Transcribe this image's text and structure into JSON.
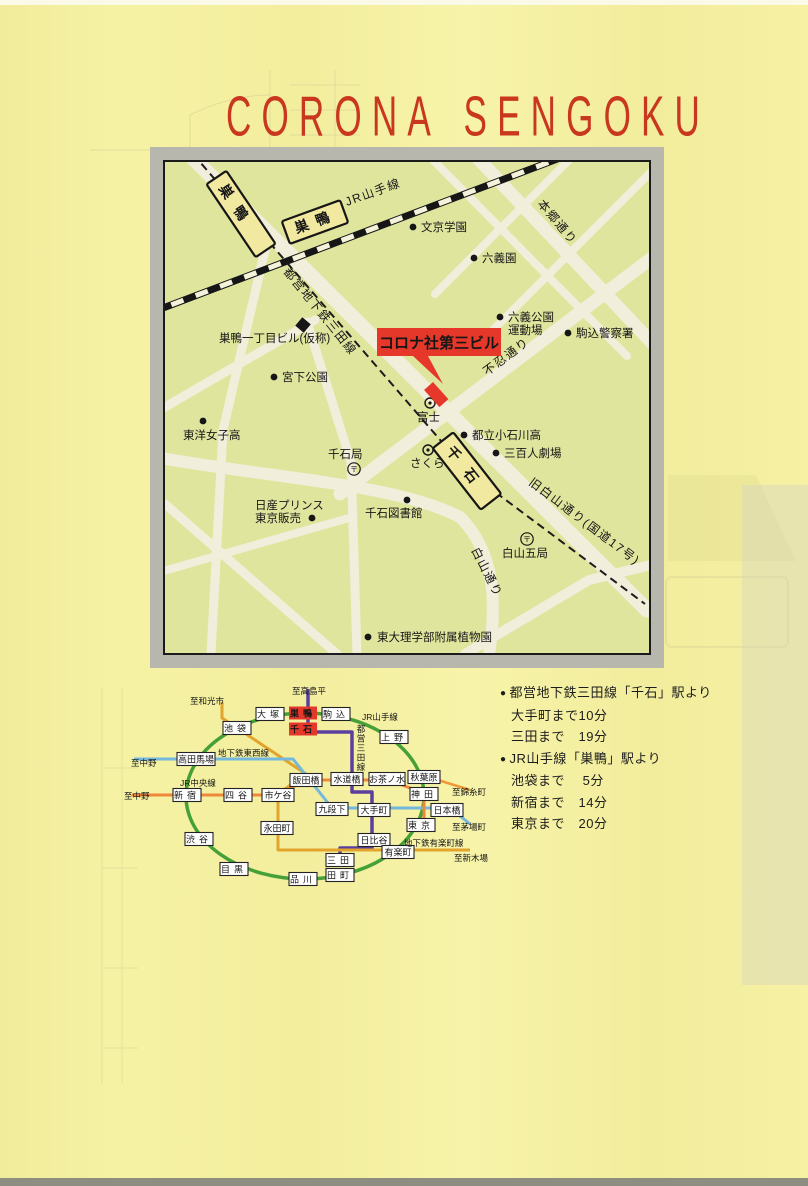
{
  "page": {
    "title": "CORONA SENGOKU"
  },
  "colors": {
    "title_red": "#c8371e",
    "map_bg": "#e0e59e",
    "road": "#f1eedb",
    "marker_red": "#e6382a",
    "jr_green": "#45a038",
    "mita_purple": "#5b3f9e",
    "yurakucho_gold": "#e2a42c",
    "tozai_blue": "#74b8dc",
    "chuo_orange": "#ef8838",
    "frame_gray": "#b7b7ae"
  },
  "map": {
    "roads": [
      {
        "pts": [
          [
            20,
            -12
          ],
          [
            482,
            448
          ]
        ],
        "w": 15
      },
      {
        "pts": [
          [
            305,
            -12
          ],
          [
            488,
            182
          ]
        ],
        "w": 13
      },
      {
        "pts": [
          [
            175,
            332
          ],
          [
            492,
            92
          ]
        ],
        "w": 13
      },
      {
        "path": "M-10,295 C120,318 230,322 295,355 C330,390 332,440 324,492",
        "w": 12
      },
      {
        "pts": [
          [
            -12,
            252
          ],
          [
            150,
            158
          ]
        ],
        "w": 9
      },
      {
        "pts": [
          [
            100,
            88
          ],
          [
            58,
            268
          ],
          [
            46,
            492
          ]
        ],
        "w": 9
      },
      {
        "pts": [
          [
            258,
            -12
          ],
          [
            462,
            194
          ]
        ],
        "w": 8
      },
      {
        "pts": [
          [
            488,
            8
          ],
          [
            316,
            180
          ]
        ],
        "w": 8
      },
      {
        "pts": [
          [
            414,
            -12
          ],
          [
            270,
            132
          ]
        ],
        "w": 8
      },
      {
        "pts": [
          [
            142,
            160
          ],
          [
            186,
            300
          ],
          [
            192,
            492
          ]
        ],
        "w": 9
      },
      {
        "pts": [
          [
            0,
            342
          ],
          [
            172,
            492
          ]
        ],
        "w": 9
      },
      {
        "pts": [
          [
            -12,
            412
          ],
          [
            184,
            356
          ]
        ],
        "w": 8
      },
      {
        "pts": [
          [
            300,
            492
          ],
          [
            424,
            418
          ],
          [
            490,
            402
          ]
        ],
        "w": 10
      }
    ],
    "jr_track": {
      "pts": [
        [
          -18,
          152
        ],
        [
          432,
          -18
        ]
      ]
    },
    "subway_dashed": {
      "pts": [
        [
          28,
          -8
        ],
        [
          302,
          309
        ],
        [
          480,
          442
        ]
      ]
    },
    "road_labels": [
      {
        "text": "JR山手線",
        "x": 182,
        "y": 44,
        "rot": -20
      },
      {
        "text": "都営地下鉄三田線",
        "x": 118,
        "y": 110,
        "rot": 51
      },
      {
        "text": "本郷通り",
        "x": 372,
        "y": 42,
        "rot": 50
      },
      {
        "text": "不忍通り",
        "x": 322,
        "y": 214,
        "rot": -37
      },
      {
        "text": "旧白山通り(国道17号)",
        "x": 363,
        "y": 322,
        "rot": 37
      },
      {
        "text": "白山通り",
        "x": 306,
        "y": 388,
        "rot": 63
      }
    ],
    "stations": [
      {
        "label": "巣鴨",
        "x": 76,
        "y": 52,
        "rot": 56,
        "w": 88,
        "h": 24,
        "ls": 12
      },
      {
        "label": "巣鴨",
        "x": 150,
        "y": 60,
        "rot": -20,
        "w": 62,
        "h": 24,
        "ls": 8
      },
      {
        "label": "千石",
        "x": 302,
        "y": 309,
        "rot": 52,
        "w": 78,
        "h": 26,
        "ls": 14
      }
    ],
    "landmarks": [
      {
        "lines": [
          "文京学園"
        ],
        "tx": 256,
        "ty": 69,
        "marker": "dot",
        "mx": 248,
        "my": 65
      },
      {
        "lines": [
          "六義園"
        ],
        "tx": 317,
        "ty": 100,
        "marker": "dot",
        "mx": 309,
        "my": 96
      },
      {
        "lines": [
          "六義公園",
          "運動場"
        ],
        "tx": 343,
        "ty": 159,
        "marker": "dot",
        "mx": 335,
        "my": 155
      },
      {
        "lines": [
          "駒込警察署"
        ],
        "tx": 411,
        "ty": 175,
        "marker": "dot",
        "mx": 403,
        "my": 171
      },
      {
        "lines": [
          "巣鴨一丁目ビル(仮称)"
        ],
        "tx": 54,
        "ty": 180,
        "marker": "square",
        "mx": 138,
        "my": 163
      },
      {
        "lines": [
          "宮下公園"
        ],
        "tx": 117,
        "ty": 219,
        "marker": "dot",
        "mx": 109,
        "my": 215
      },
      {
        "lines": [
          "東洋女子高"
        ],
        "tx": 18,
        "ty": 277,
        "marker": "dot",
        "mx": 38,
        "my": 259
      },
      {
        "lines": [
          "都立小石川高"
        ],
        "tx": 307,
        "ty": 277,
        "marker": "dot",
        "mx": 299,
        "my": 273
      },
      {
        "lines": [
          "三百人劇場"
        ],
        "tx": 339,
        "ty": 295,
        "marker": "dot",
        "mx": 331,
        "my": 291
      },
      {
        "lines": [
          "千石図書館"
        ],
        "tx": 200,
        "ty": 355,
        "marker": "dot",
        "mx": 242,
        "my": 338
      },
      {
        "lines": [
          "日産プリンス",
          "東京販売"
        ],
        "tx": 90,
        "ty": 347,
        "marker": "dot",
        "mx": 147,
        "my": 356
      },
      {
        "lines": [
          "東大理学部附属植物園"
        ],
        "tx": 212,
        "ty": 479,
        "marker": "dot",
        "mx": 203,
        "my": 475
      }
    ],
    "postals": [
      {
        "text": "千石局",
        "tx": 163,
        "ty": 296,
        "cx": 189,
        "cy": 307
      },
      {
        "text": "白山五局",
        "tx": 337,
        "ty": 395,
        "cx": 362,
        "cy": 377
      }
    ],
    "banks": [
      {
        "text": "富士",
        "tx": 252,
        "ty": 259,
        "cx": 265,
        "cy": 241
      },
      {
        "text": "さくら",
        "tx": 245,
        "ty": 305,
        "cx": 263,
        "cy": 288
      }
    ],
    "corona": {
      "text": "コロナ社第三ビル",
      "box": {
        "x": 212,
        "y": 166,
        "w": 124,
        "h": 28
      },
      "pointer": [
        [
          248,
          194
        ],
        [
          263,
          194
        ],
        [
          278,
          222
        ]
      ],
      "building": {
        "x": 268,
        "y": 220,
        "w": 23,
        "h": 12,
        "rot": 48
      }
    }
  },
  "diagram": {
    "lines": [
      {
        "name": "jr-yamanote-loop",
        "type": "ellipse",
        "cx": 187,
        "cy": 124,
        "rx": 119,
        "ry": 83,
        "color": "#45a038",
        "w": 3.5
      },
      {
        "name": "toei-mita-line",
        "path": "M190,17 V60 H234 V120 H254 V176 H222 V186",
        "color": "#5b3f9e",
        "w": 3.5
      },
      {
        "name": "yurakucho-line",
        "path": "M104,30 V46 L188,102 L160,122 V178 H352",
        "color": "#e2a42c",
        "w": 3
      },
      {
        "name": "tozai-line",
        "path": "M16,87 H175 L214,136 H332 L352,152",
        "color": "#74b8dc",
        "w": 3
      },
      {
        "name": "chuo-line",
        "path": "M14,123 H160 L188,108 H270 L306,121 V148",
        "color": "#ef8838",
        "w": 3
      },
      {
        "name": "sobu-line",
        "path": "M320,108 L352,118",
        "color": "#ef9838",
        "w": 2.5
      }
    ],
    "stations": [
      {
        "label": "大塚",
        "x": 152,
        "y": 42
      },
      {
        "label": "巣鴨",
        "x": 185,
        "y": 41,
        "red": true
      },
      {
        "label": "駒込",
        "x": 218,
        "y": 42
      },
      {
        "label": "千石",
        "x": 185,
        "y": 57,
        "red": true
      },
      {
        "label": "池袋",
        "x": 119,
        "y": 56
      },
      {
        "label": "上野",
        "x": 276,
        "y": 65
      },
      {
        "label": "高田馬場",
        "x": 78,
        "y": 87,
        "w": 38
      },
      {
        "label": "新宿",
        "x": 69,
        "y": 123
      },
      {
        "label": "四谷",
        "x": 120,
        "y": 123
      },
      {
        "label": "市ケ谷",
        "x": 160,
        "y": 123,
        "w": 32
      },
      {
        "label": "飯田橋",
        "x": 188,
        "y": 108,
        "w": 32
      },
      {
        "label": "水道橋",
        "x": 229,
        "y": 107,
        "w": 32
      },
      {
        "label": "お茶ノ水",
        "x": 269,
        "y": 107,
        "w": 36
      },
      {
        "label": "秋葉原",
        "x": 306,
        "y": 105,
        "w": 32
      },
      {
        "label": "神田",
        "x": 306,
        "y": 122
      },
      {
        "label": "九段下",
        "x": 214,
        "y": 137,
        "w": 32
      },
      {
        "label": "大手町",
        "x": 256,
        "y": 138,
        "w": 32
      },
      {
        "label": "日本橋",
        "x": 329,
        "y": 138,
        "w": 32
      },
      {
        "label": "東京",
        "x": 303,
        "y": 153
      },
      {
        "label": "日比谷",
        "x": 256,
        "y": 168,
        "w": 32
      },
      {
        "label": "有楽町",
        "x": 280,
        "y": 180,
        "w": 32
      },
      {
        "label": "永田町",
        "x": 159,
        "y": 156,
        "w": 32
      },
      {
        "label": "渋谷",
        "x": 81,
        "y": 167
      },
      {
        "label": "目黒",
        "x": 116,
        "y": 197
      },
      {
        "label": "品川",
        "x": 185,
        "y": 207
      },
      {
        "label": "三田",
        "x": 222,
        "y": 188
      },
      {
        "label": "田町",
        "x": 222,
        "y": 203
      }
    ],
    "labels": [
      {
        "text": "至高島平",
        "x": 174,
        "y": 22
      },
      {
        "text": "至和光市",
        "x": 72,
        "y": 32
      },
      {
        "text": "JR山手線",
        "x": 244,
        "y": 48
      },
      {
        "text": "地下鉄東西線",
        "x": 100,
        "y": 84
      },
      {
        "text": "JR中央線",
        "x": 62,
        "y": 114
      },
      {
        "text": "都営三田線",
        "x": 243,
        "y": 60,
        "vertical": true
      },
      {
        "text": "至中野",
        "x": 13,
        "y": 94
      },
      {
        "text": "至中野",
        "x": 6,
        "y": 127
      },
      {
        "text": "至錦糸町",
        "x": 334,
        "y": 123
      },
      {
        "text": "至茅場町",
        "x": 334,
        "y": 158
      },
      {
        "text": "地下鉄有楽町線",
        "x": 286,
        "y": 174
      },
      {
        "text": "至新木場",
        "x": 336,
        "y": 189
      }
    ]
  },
  "access": {
    "lines": [
      {
        "bullet": true,
        "text": "都営地下鉄三田線「千石」駅より"
      },
      {
        "bullet": false,
        "text": "大手町まで10分"
      },
      {
        "bullet": false,
        "text": "三田まで　19分"
      },
      {
        "bullet": true,
        "text": "JR山手線「巣鴨」駅より"
      },
      {
        "bullet": false,
        "text": "池袋まで　 5分"
      },
      {
        "bullet": false,
        "text": "新宿まで　14分"
      },
      {
        "bullet": false,
        "text": "東京まで　20分"
      }
    ]
  }
}
